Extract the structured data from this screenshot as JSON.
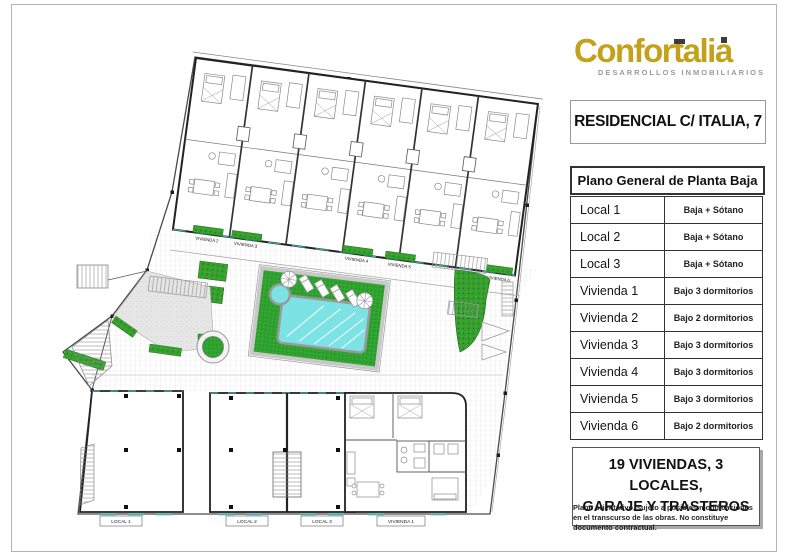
{
  "brand": {
    "name": "Confortalia",
    "tagline": "DESARROLLOS INMOBILIARIOS",
    "gold": "#c3a11b"
  },
  "header": {
    "project_title": "RESIDENCIAL C/ ITALIA, 7"
  },
  "table": {
    "title": "Plano General de Planta Baja",
    "rows": [
      {
        "name": "Local 1",
        "desc": "Baja + Sótano"
      },
      {
        "name": "Local 2",
        "desc": "Baja + Sótano"
      },
      {
        "name": "Local 3",
        "desc": "Baja + Sótano"
      },
      {
        "name": "Vivienda 1",
        "desc": "Bajo 3 dormitorios"
      },
      {
        "name": "Vivienda 2",
        "desc": "Bajo 2 dormitorios"
      },
      {
        "name": "Vivienda 3",
        "desc": "Bajo 3 dormitorios"
      },
      {
        "name": "Vivienda 4",
        "desc": "Bajo 3 dormitorios"
      },
      {
        "name": "Vivienda 5",
        "desc": "Bajo 3 dormitorios"
      },
      {
        "name": "Vivienda 6",
        "desc": "Bajo 2 dormitorios"
      }
    ]
  },
  "summary": {
    "line1": "19 VIVIENDAS, 3 LOCALES,",
    "line2": "GARAJE Y TRASTEROS"
  },
  "disclaimer": "Plano orientativo, sujeto a posibles modificaciones en el transcurso de las obras. No constituye documento contractual.",
  "plan": {
    "top_unit_labels": [
      "VIVIENDA 2",
      "VIVIENDA 3",
      "VIVIENDA 4",
      "VIVIENDA 5",
      "VIVIENDA 6"
    ],
    "bottom_unit_labels": [
      "LOCAL 1",
      "LOCAL 2",
      "LOCAL 3",
      "VIVIENDA 1"
    ],
    "colors": {
      "lawn": "#2fa230",
      "pool": "#7de2e4",
      "paving": "#ededed",
      "accent_teal": "#3fb3b5"
    }
  }
}
